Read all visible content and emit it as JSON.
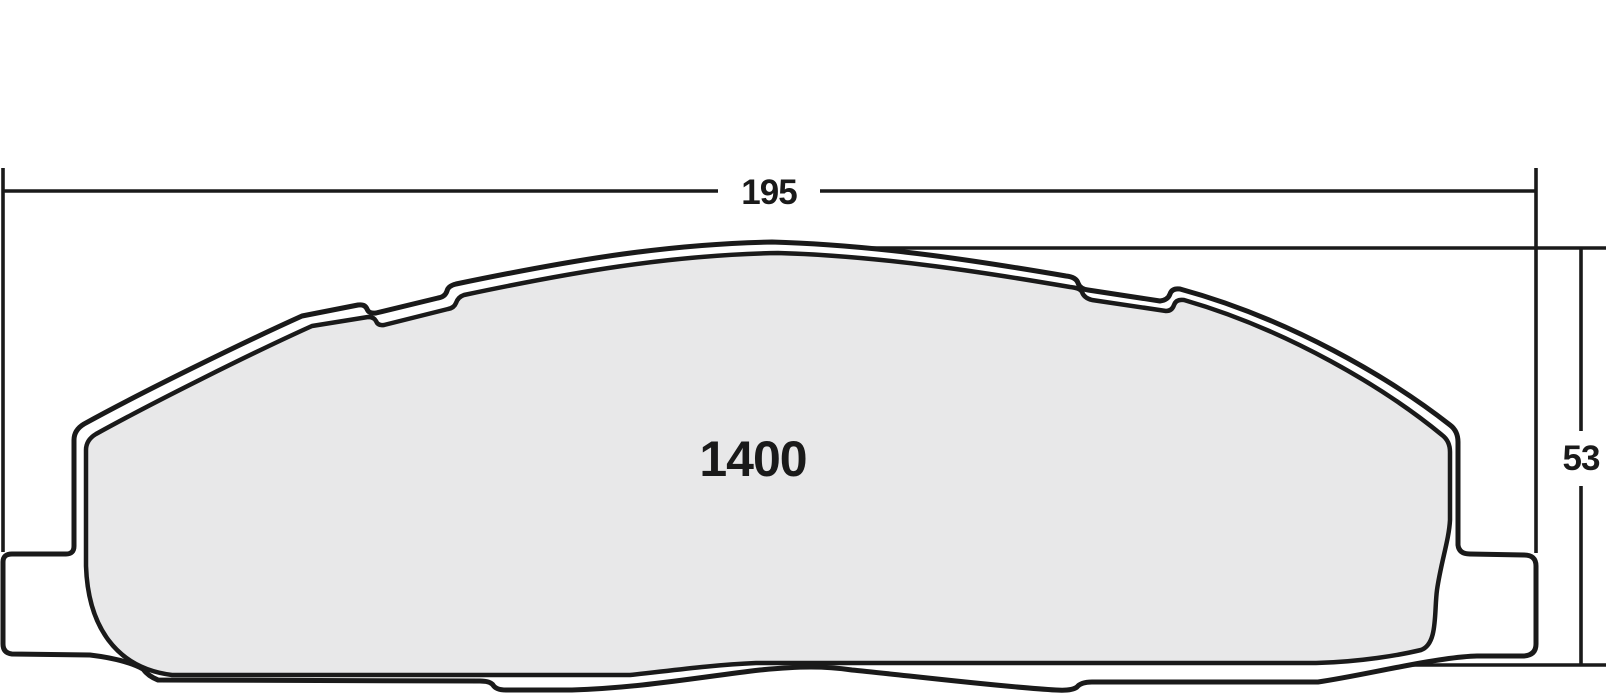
{
  "diagram": {
    "type": "brake-pad-technical-drawing",
    "part_number": "1400",
    "dimensions": {
      "width": {
        "label": "195"
      },
      "height": {
        "label": "53"
      }
    },
    "colors": {
      "background": "#ffffff",
      "outline": "#1a1a1a",
      "backing_fill": "#ffffff",
      "friction_fill": "#e8e8e9",
      "dimension_line": "#1a1a1a",
      "label_color": "#1a1a1a"
    }
  }
}
